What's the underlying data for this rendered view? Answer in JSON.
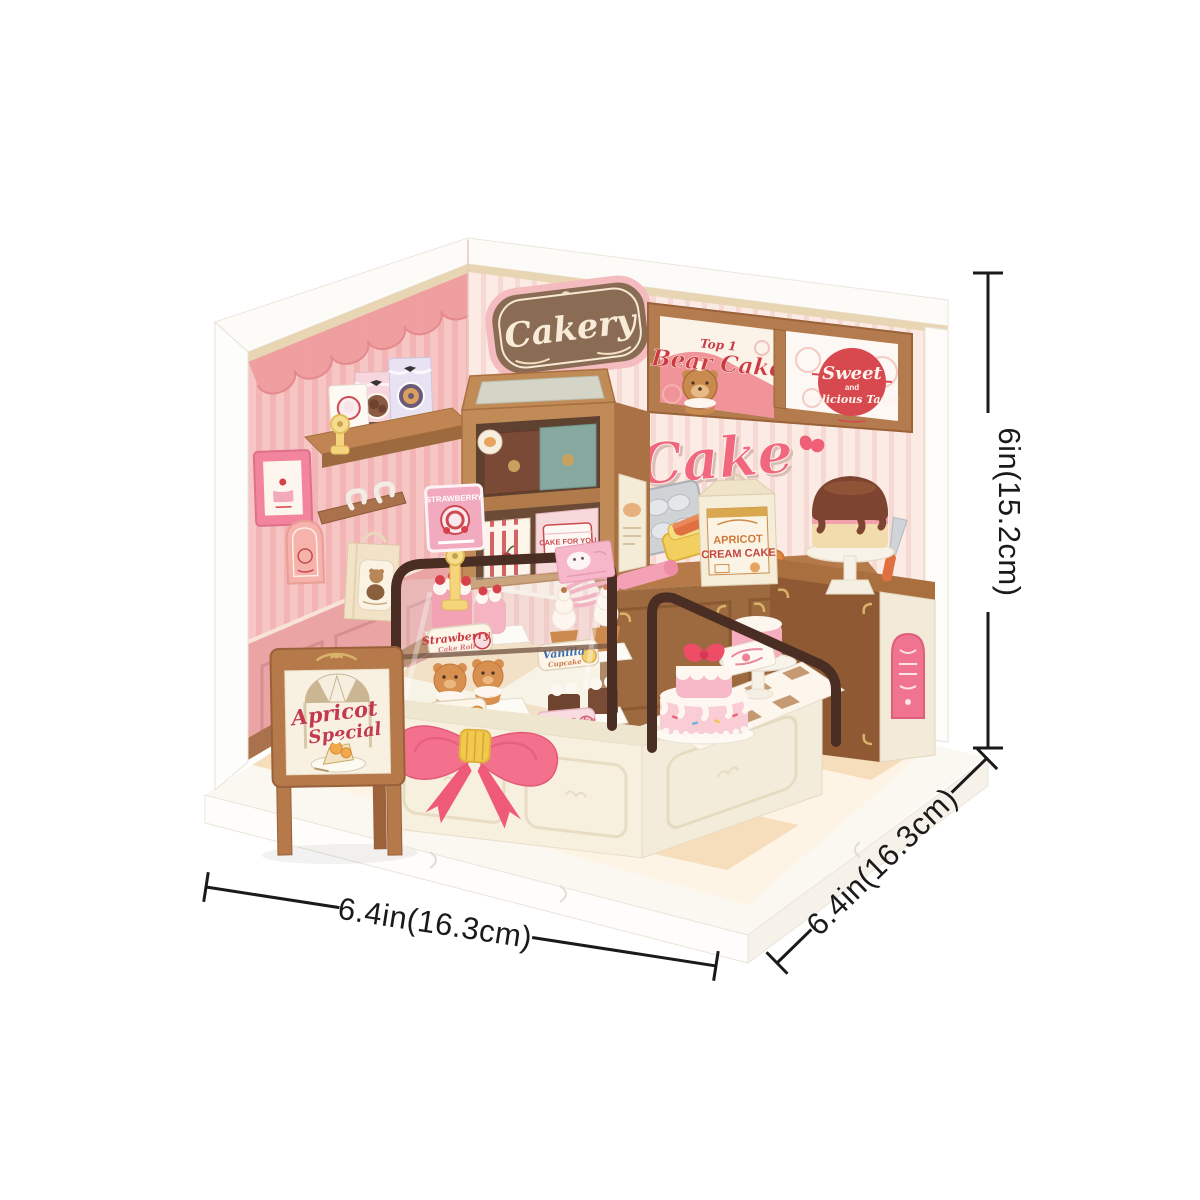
{
  "signs": {
    "cakery": "Cakery",
    "bear_poster_top": "Top 1",
    "bear_poster_title": "Bear Cake",
    "sweet_poster_line1": "Sweet",
    "sweet_poster_line2": "and",
    "sweet_poster_line3": "Delicious Taste",
    "wall_script": "Cake",
    "aframe_line1": "Apricot",
    "aframe_line2": "Special",
    "strawberry_stand_sign": "STRAWBERRY",
    "apricot_box_line1": "APRICOT",
    "apricot_box_line2": "CREAM CAKE",
    "cake_for_you_box": "CAKE FOR YOU"
  },
  "display_case_labels": {
    "strawberry_title": "Strawberry",
    "strawberry_sub": "Cake Roll",
    "vanilla_title": "Vanilla",
    "vanilla_sub": "Cupcake",
    "bear_title": "Bear Cake",
    "cream_title": "Cream Cake"
  },
  "dimensions": {
    "height": "6in(15.2cm)",
    "width_front": "6.4in(16.3cm)",
    "depth_side": "6.4in(16.3cm)"
  },
  "colors": {
    "background": "#ffffff",
    "wall_pink": "#f6c6c5",
    "wall_scallop_rose": "#ee9d9e",
    "back_wall_blush": "#fcebe5",
    "wood_brown": "#b5794a",
    "case_frame_brown": "#4a2d23",
    "counter_cream": "#f7f0df",
    "bow_pink": "#f4718d",
    "accent_pink": "#f0677e",
    "poster_red": "#d8494f",
    "label_red": "#c23a44",
    "dimension_ink": "#1a1a1a"
  }
}
